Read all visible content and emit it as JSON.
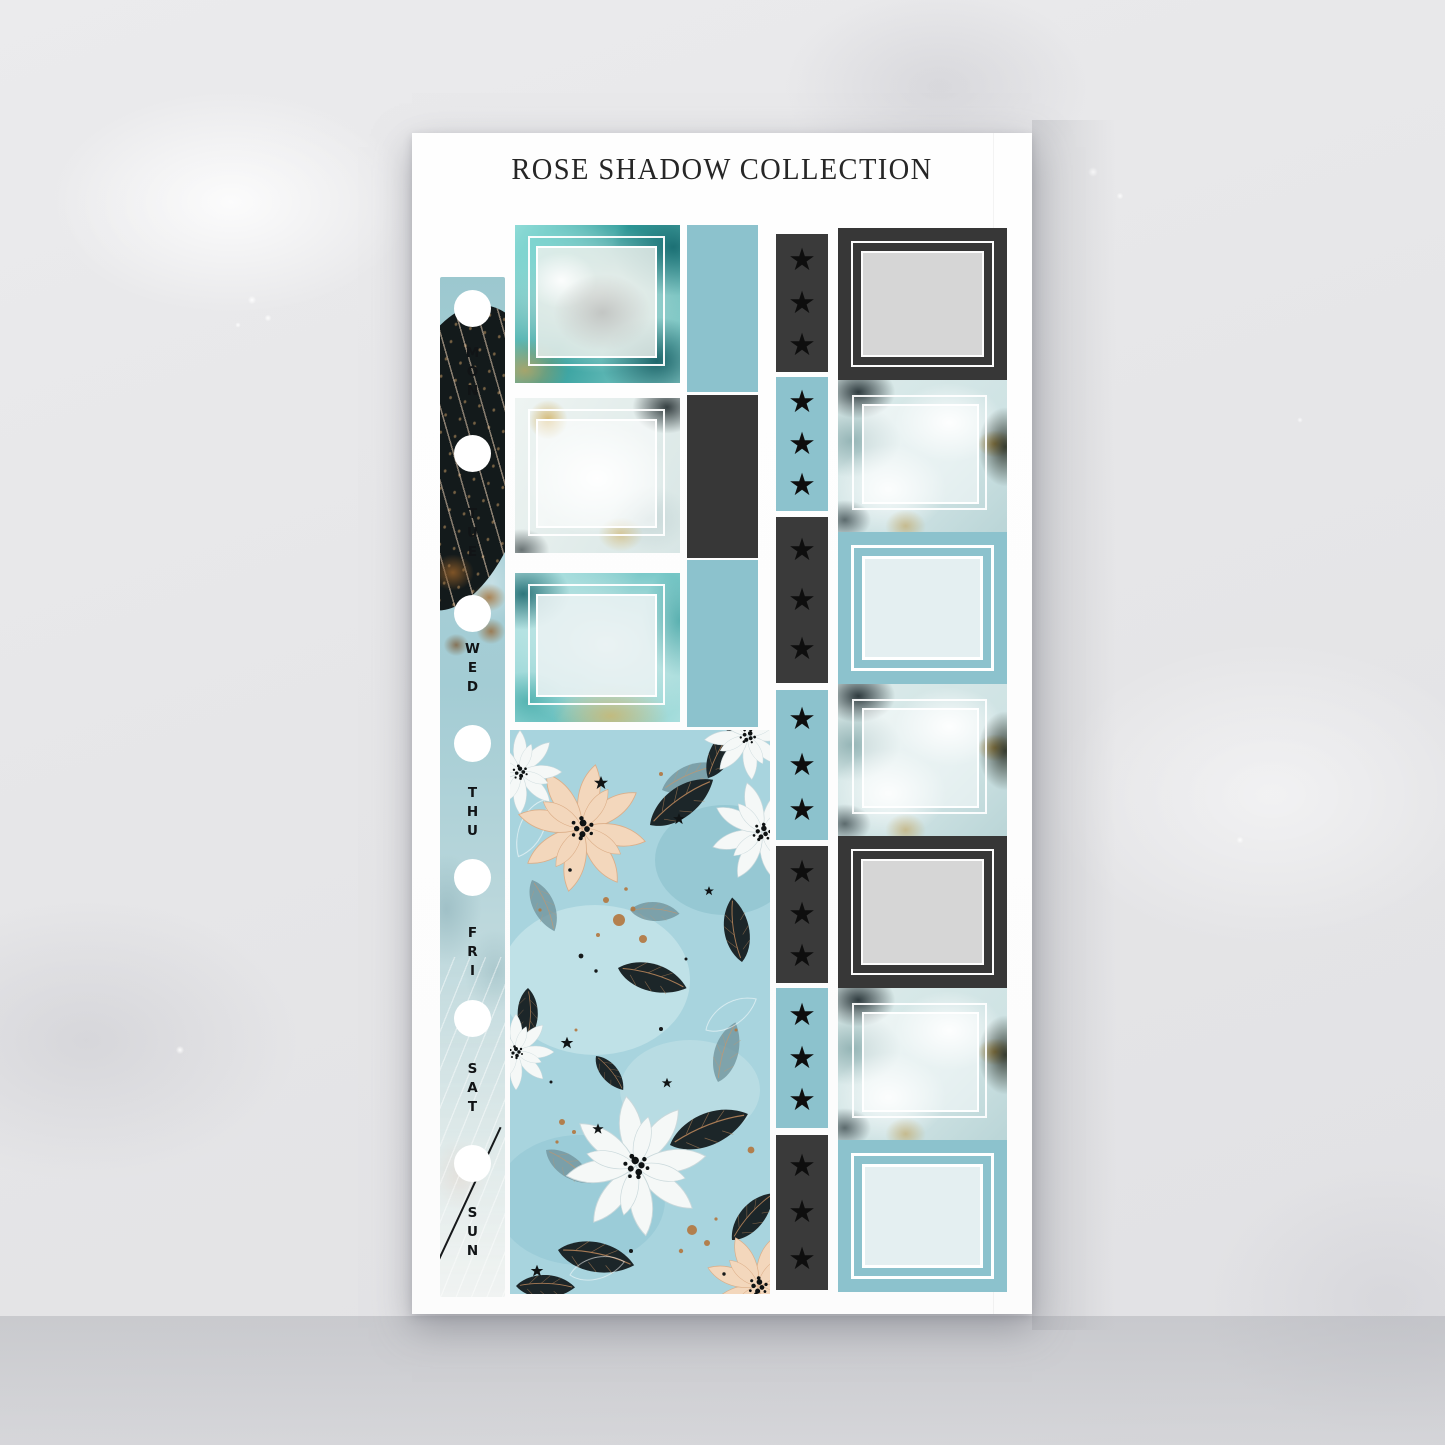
{
  "title": "ROSE SHADOW COLLECTION",
  "sheet": {
    "type": "planner sticker sheet",
    "background": "#ffffff"
  },
  "date_strip": {
    "days": [
      "MON",
      "TUE",
      "WED",
      "THU",
      "FRI",
      "SAT",
      "SUN"
    ],
    "hole_count": 7,
    "decorations": [
      "black-leaf",
      "copper-splatter",
      "white-feather-lines",
      "black-diagonal-line"
    ]
  },
  "glyphs": {
    "star": "★"
  },
  "star_checklist": {
    "stars_per_segment": 3,
    "segments": [
      {
        "bg": "charcoal"
      },
      {
        "bg": "teal"
      },
      {
        "bg": "charcoal"
      },
      {
        "bg": "teal"
      },
      {
        "bg": "charcoal"
      },
      {
        "bg": "teal"
      },
      {
        "bg": "charcoal"
      }
    ]
  },
  "middle_column": {
    "full_boxes": [
      {
        "style": "teal-marble",
        "frame": "double-white"
      },
      {
        "style": "white-floral",
        "frame": "double-white"
      },
      {
        "style": "light-teal-marble",
        "frame": "double-white"
      }
    ],
    "side_bars": [
      {
        "color": "teal"
      },
      {
        "color": "charcoal"
      },
      {
        "color": "teal"
      }
    ],
    "floral_block": {
      "background": "light-teal watercolor",
      "motifs": [
        "peach poinsettia flowers",
        "white poinsettia flowers",
        "black leaves with copper veins",
        "copper splatter",
        "small black stars"
      ]
    }
  },
  "right_column": {
    "boxes": [
      {
        "style": "charcoal-gray-square"
      },
      {
        "style": "floral-white-square"
      },
      {
        "style": "teal-lightblue-square"
      },
      {
        "style": "floral-white-square"
      },
      {
        "style": "charcoal-gray-square"
      },
      {
        "style": "floral-white-square"
      },
      {
        "style": "teal-lightblue-square"
      }
    ]
  },
  "colors": {
    "teal": "#8cc2cd",
    "charcoal": "#3a3a3a",
    "gray_square": "#d6d6d6",
    "light_blue_square": "#e4eff1",
    "copper": "#b3763e",
    "floral_background": "#a8d4de",
    "peach_flower": "#f3d7bc",
    "leaf_black": "#1c2629",
    "backdrop": "#e7e7e9"
  }
}
